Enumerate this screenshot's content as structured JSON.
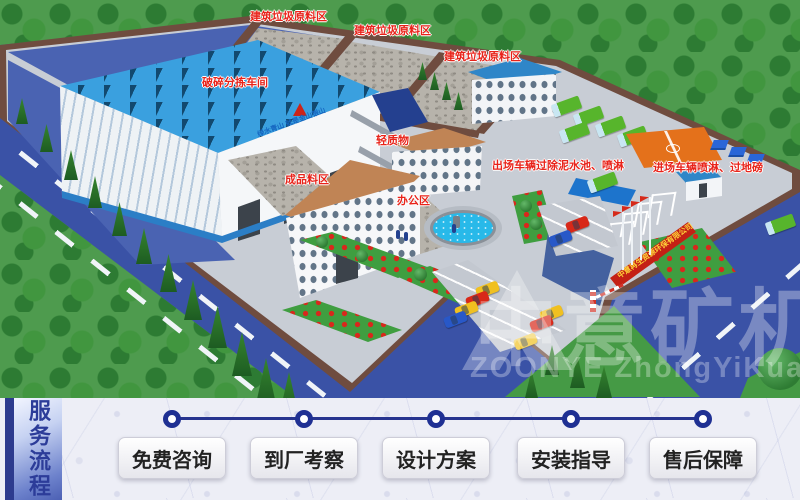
{
  "scene": {
    "labels": [
      {
        "text": "建筑垃圾原料区"
      },
      {
        "text": "建筑垃圾原料区"
      },
      {
        "text": "建筑垃圾原料区"
      },
      {
        "text": "破碎分拣车间"
      },
      {
        "text": "轻质物"
      },
      {
        "text": "出场车辆过除泥水池、喷淋"
      },
      {
        "text": "进场车辆喷淋、过地磅"
      },
      {
        "text": "成品料区"
      },
      {
        "text": "办公区"
      }
    ],
    "factory_slogan": "绿水青山 就是金山银山",
    "gate_sign": "中意再生资源环保有限公司",
    "watermark": {
      "cn": "中意矿机",
      "en": "ZOONYE ZhongYiKuangJi"
    }
  },
  "process_bar": {
    "banner": "服务流程",
    "steps": [
      {
        "label": "免费咨询"
      },
      {
        "label": "到厂考察"
      },
      {
        "label": "设计方案"
      },
      {
        "label": "安装指导"
      },
      {
        "label": "售后保障"
      }
    ]
  },
  "colors": {
    "label_red": "#e8231a",
    "banner_text_blue": "#2c3c99",
    "timeline_navy": "#27348f",
    "roof_blue": "#3aa0df",
    "road_blue": "#3a52a6",
    "court_orange": "#e4711b"
  }
}
